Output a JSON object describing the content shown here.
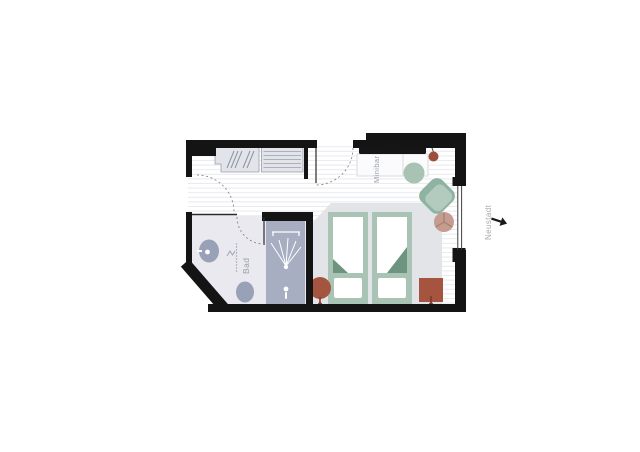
{
  "plan": {
    "type": "hotel-room-floor-plan",
    "room_labels": {
      "bathroom": "Bad",
      "minibar": "Minibar"
    },
    "outside": {
      "district": "Neustadt",
      "arrow_direction": "right"
    }
  },
  "colors": {
    "wall": "#141414",
    "floor_stripe": "#e8eaee",
    "bath_floor": "#e9e9ef",
    "shower": "#a7aec2",
    "sanitary": "#98a1b7",
    "fixture_white": "#ffffff",
    "panel": "#e2e4e9",
    "panel_line": "#98a0ad",
    "console": "#fbfbfd",
    "console_line": "#d9dbe0",
    "platform": "#e2e4e8",
    "bed_frame": "#a9c4b5",
    "bed_fold": "#6e937f",
    "duvet": "#ffffff",
    "chair_back": "#8fb3a1",
    "chair_seat": "#b3cbbe",
    "table_green": "#a8c3b4",
    "table_rose": "#c59c90",
    "table_rose_line": "#a87e72",
    "stool": "#a4543f",
    "stool_pin": "#7d3b2b",
    "pendant": "#9e4f3c",
    "tv": "#151515",
    "label": "#9aa0a6",
    "outside_label": "#a9a9a9",
    "arrow": "#1a1a1a",
    "door_arc": "#8a8a8a"
  }
}
